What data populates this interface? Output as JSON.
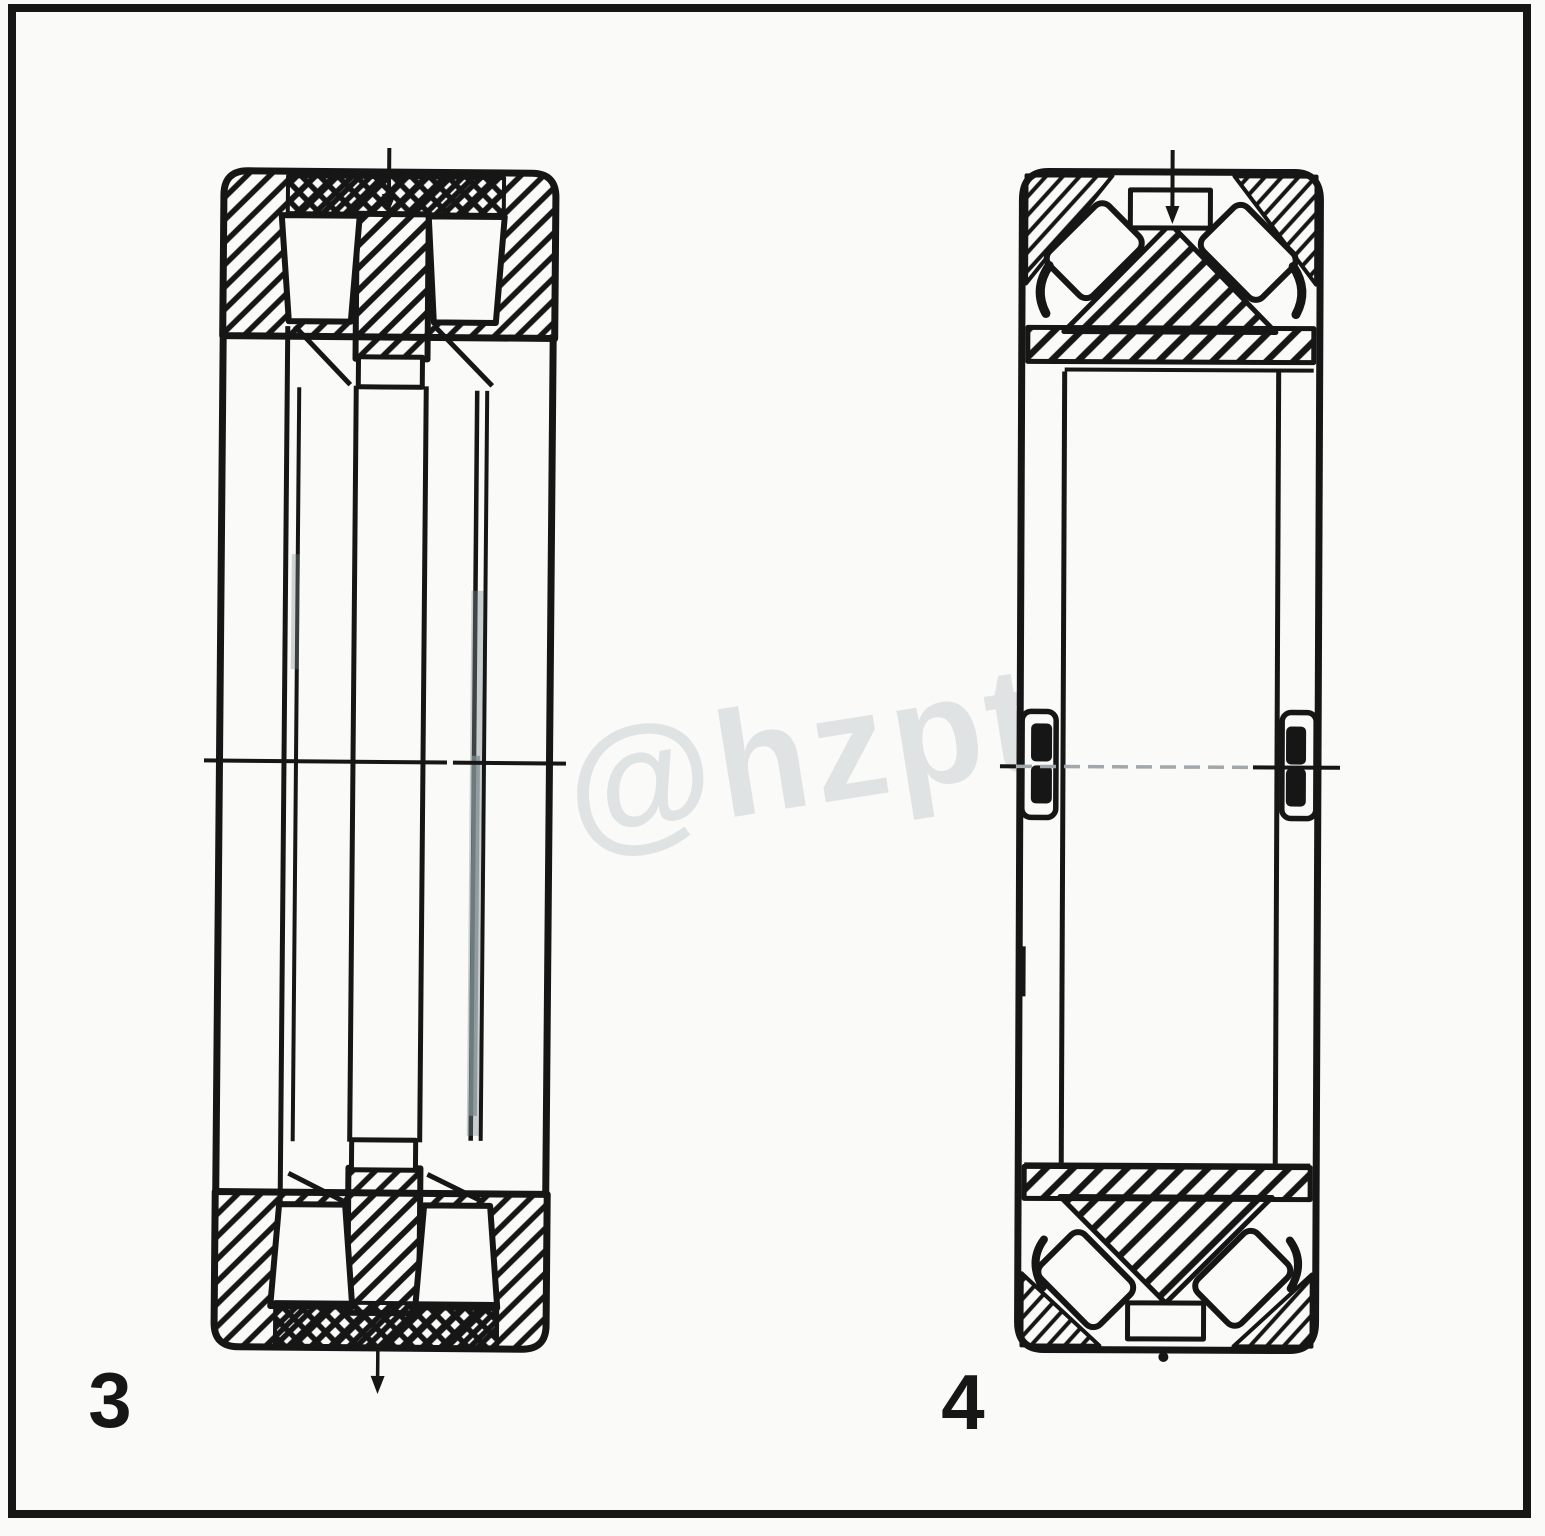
{
  "page": {
    "background": "#fafaf8",
    "frame_color": "#161616"
  },
  "figures": {
    "left_label": "3",
    "right_label": "4"
  },
  "watermark": {
    "text": "@hzpt"
  },
  "colors": {
    "ink": "#161616",
    "paper": "#fafaf8",
    "smudge": "#7e8c90",
    "centerline_gray": "#a0a8ab",
    "watermark_gray": "#c6ced1"
  }
}
